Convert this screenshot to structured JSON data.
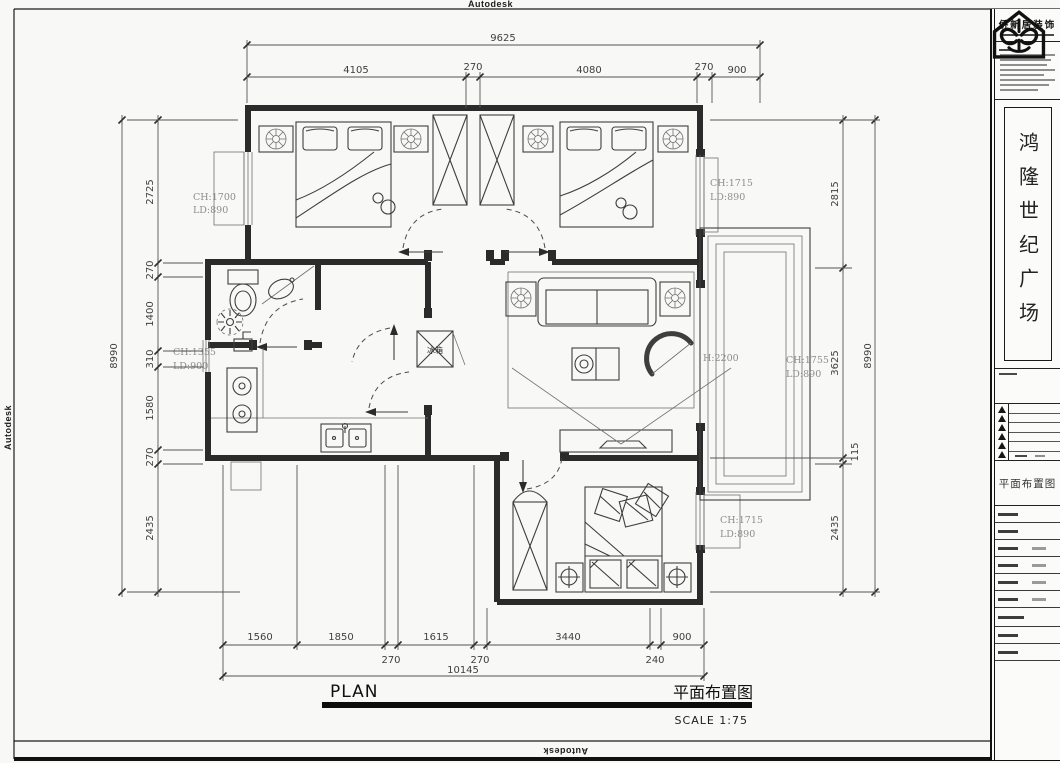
{
  "watermarks": {
    "top": "Autodesk",
    "bottom": "Autodesk",
    "left": "Autodesk"
  },
  "plan_title": {
    "en": "PLAN",
    "cn": "平面布置图",
    "scale": "SCALE 1:75"
  },
  "dims": {
    "top_overall": "9625",
    "top_seg": [
      "4105",
      "270",
      "4080",
      "270",
      "900"
    ],
    "bottom_row1": [
      "1560",
      "1850",
      "1615",
      "3440",
      "900"
    ],
    "bottom_row2": [
      "270",
      "270",
      "240"
    ],
    "bottom_overall": "10145",
    "left_overall": "8990",
    "left_seg": [
      "2725",
      "270",
      "1400",
      "310",
      "1580",
      "270",
      "2435"
    ],
    "right_seg": [
      "2815",
      "3625",
      "115",
      "2435"
    ],
    "right_overall": "8990"
  },
  "labels": {
    "win_tl_1": "CH:1700",
    "win_tl_2": "LD:890",
    "win_ml_1": "CH:1355",
    "win_ml_2": "LD:900",
    "win_tr_1": "CH:1715",
    "win_tr_2": "LD:890",
    "win_br_1": "CH:1715",
    "win_br_2": "LD:890",
    "balcony_win_1": "CH:1755",
    "balcony_win_2": "LD:890",
    "balcony_h": "H:2200",
    "fridge": "冰箱"
  },
  "titleblock": {
    "company": "侨新居装饰",
    "project": "鸿隆世纪广场",
    "drawing_title": "平面布置图"
  }
}
